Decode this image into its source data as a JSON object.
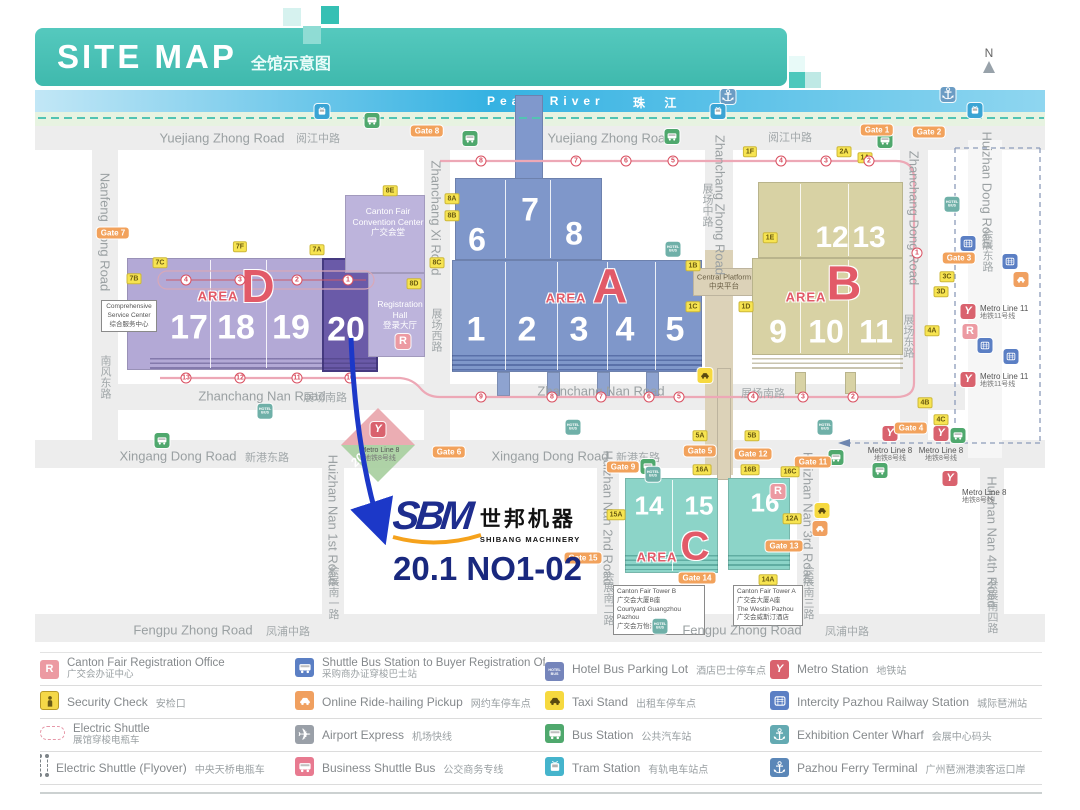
{
  "header": {
    "title": "SITE MAP",
    "subtitle": "全馆示意图"
  },
  "compass": {
    "label": "N"
  },
  "river": {
    "en": "Pearl River",
    "zh": "珠 江"
  },
  "callout": {
    "logo": "SBM",
    "logo_zh": "世邦机器",
    "logo_sub": "SHIBANG MACHINERY",
    "booth": "20.1 NO1-02"
  },
  "areas": {
    "a": {
      "word": "AREA",
      "letter": "A"
    },
    "b": {
      "word": "AREA",
      "letter": "B"
    },
    "c": {
      "word": "AREA",
      "letter": "C"
    },
    "d": {
      "word": "AREA",
      "letter": "D"
    }
  },
  "buildings": {
    "convention_center": {
      "l1": "Canton Fair",
      "l2": "Convention Center",
      "l3": "广交会堂"
    },
    "registration_hall": {
      "l1": "Registration",
      "l2": "Hall",
      "l3": "登录大厅"
    },
    "service_center": {
      "l1": "Comprehensive",
      "l2": "Service Center",
      "l3": "综合服务中心"
    },
    "central_platform": {
      "l1": "Central Platform",
      "l2": "中央平台"
    },
    "tower_b": {
      "l1": "Canton Fair Tower B",
      "l2": "广交会大厦B座",
      "l3": "Courtyard Guangzhou Pazhou",
      "l4": "广交会万怡酒店"
    },
    "tower_a": {
      "l1": "Canton Fair Tower A",
      "l2": "广交会大厦A座",
      "l3": "The Westin Pazhou",
      "l4": "广交会威斯汀酒店"
    }
  },
  "diamond": {
    "en": "Metro Line 8",
    "zh": "地铁8号线",
    "num": "20"
  },
  "halls": [
    {
      "t": "17",
      "x": 189,
      "y": 328,
      "s": 34
    },
    {
      "t": "18",
      "x": 236,
      "y": 328,
      "s": 34
    },
    {
      "t": "19",
      "x": 291,
      "y": 328,
      "s": 34
    },
    {
      "t": "20",
      "x": 346,
      "y": 330,
      "s": 34
    },
    {
      "t": "6",
      "x": 477,
      "y": 240,
      "s": 32
    },
    {
      "t": "7",
      "x": 530,
      "y": 210,
      "s": 32
    },
    {
      "t": "8",
      "x": 574,
      "y": 234,
      "s": 32
    },
    {
      "t": "1",
      "x": 476,
      "y": 330,
      "s": 34
    },
    {
      "t": "2",
      "x": 527,
      "y": 330,
      "s": 34
    },
    {
      "t": "3",
      "x": 579,
      "y": 330,
      "s": 34
    },
    {
      "t": "4",
      "x": 625,
      "y": 330,
      "s": 34
    },
    {
      "t": "5",
      "x": 675,
      "y": 330,
      "s": 34
    },
    {
      "t": "12",
      "x": 832,
      "y": 238,
      "s": 30
    },
    {
      "t": "13",
      "x": 869,
      "y": 238,
      "s": 30
    },
    {
      "t": "9",
      "x": 778,
      "y": 332,
      "s": 32
    },
    {
      "t": "10",
      "x": 826,
      "y": 332,
      "s": 32
    },
    {
      "t": "11",
      "x": 876,
      "y": 332,
      "s": 32
    },
    {
      "t": "14",
      "x": 649,
      "y": 506,
      "s": 26
    },
    {
      "t": "15",
      "x": 699,
      "y": 506,
      "s": 26
    },
    {
      "t": "16",
      "x": 765,
      "y": 503,
      "s": 26
    }
  ],
  "road_labels": [
    {
      "t": "Yuejiang Zhong Road",
      "x": 222,
      "y": 138
    },
    {
      "t": "阅江中路",
      "x": 318,
      "y": 138,
      "zh": 1
    },
    {
      "t": "Yuejiang Zhong Road",
      "x": 610,
      "y": 138
    },
    {
      "t": "阅江中路",
      "x": 790,
      "y": 137,
      "zh": 1
    },
    {
      "t": "Zhanchang Nan Road",
      "x": 262,
      "y": 396
    },
    {
      "t": "展场南路",
      "x": 325,
      "y": 397,
      "zh": 1
    },
    {
      "t": "Zhanchang Nan Road",
      "x": 601,
      "y": 391
    },
    {
      "t": "展场南路",
      "x": 763,
      "y": 393,
      "zh": 1
    },
    {
      "t": "Xingang Dong Road",
      "x": 178,
      "y": 456
    },
    {
      "t": "新港东路",
      "x": 267,
      "y": 457,
      "zh": 1
    },
    {
      "t": "Xingang Dong Road",
      "x": 550,
      "y": 456
    },
    {
      "t": "新港东路",
      "x": 638,
      "y": 457,
      "zh": 1
    },
    {
      "t": "Fengpu Zhong Road",
      "x": 193,
      "y": 630
    },
    {
      "t": "凤浦中路",
      "x": 288,
      "y": 631,
      "zh": 1
    },
    {
      "t": "Fengpu Zhong Road",
      "x": 742,
      "y": 630
    },
    {
      "t": "凤浦中路",
      "x": 847,
      "y": 631,
      "zh": 1
    },
    {
      "t": "Nanfeng Dong Road",
      "x": 105,
      "y": 232,
      "v": 1
    },
    {
      "t": "南风东路",
      "x": 105,
      "y": 377,
      "v": 1,
      "zh": 1
    },
    {
      "t": "Zhanchang Xi Road",
      "x": 436,
      "y": 218,
      "v": 1
    },
    {
      "t": "展场西路",
      "x": 436,
      "y": 330,
      "v": 1,
      "zh": 1
    },
    {
      "t": "Zhanchang Zhong Road",
      "x": 720,
      "y": 205,
      "v": 1
    },
    {
      "t": "展场中路",
      "x": 707,
      "y": 205,
      "v": 1,
      "zh": 1
    },
    {
      "t": "Zhanchang Dong Road",
      "x": 914,
      "y": 218,
      "v": 1
    },
    {
      "t": "展场东路",
      "x": 908,
      "y": 336,
      "v": 1,
      "zh": 1
    },
    {
      "t": "Huizhan Dong Road",
      "x": 987,
      "y": 190,
      "v": 1
    },
    {
      "t": "会展东路",
      "x": 987,
      "y": 250,
      "v": 1,
      "zh": 1
    },
    {
      "t": "Huizhan Nan 1st Road",
      "x": 333,
      "y": 520,
      "v": 1
    },
    {
      "t": "会展南一路",
      "x": 333,
      "y": 592,
      "v": 1,
      "zh": 1
    },
    {
      "t": "Huizhan Nan 2nd Road",
      "x": 608,
      "y": 518,
      "v": 1
    },
    {
      "t": "会展南二路",
      "x": 608,
      "y": 598,
      "v": 1,
      "zh": 1
    },
    {
      "t": "Huizhan Nan 3rd Road",
      "x": 808,
      "y": 518,
      "v": 1
    },
    {
      "t": "会展南三路",
      "x": 808,
      "y": 592,
      "v": 1,
      "zh": 1
    },
    {
      "t": "Huizhan Nan 4th Road",
      "x": 992,
      "y": 542,
      "v": 1
    },
    {
      "t": "会展南四路",
      "x": 992,
      "y": 606,
      "v": 1,
      "zh": 1
    }
  ],
  "gates": [
    {
      "t": "Gate 7",
      "x": 113,
      "y": 233
    },
    {
      "t": "Gate 8",
      "x": 427,
      "y": 131
    },
    {
      "t": "Gate 1",
      "x": 877,
      "y": 130
    },
    {
      "t": "Gate 2",
      "x": 929,
      "y": 132
    },
    {
      "t": "Gate 3",
      "x": 959,
      "y": 258
    },
    {
      "t": "Gate 4",
      "x": 911,
      "y": 428
    },
    {
      "t": "Gate 6",
      "x": 449,
      "y": 452
    },
    {
      "t": "Gate 9",
      "x": 623,
      "y": 467
    },
    {
      "t": "Gate 5",
      "x": 700,
      "y": 451
    },
    {
      "t": "Gate 12",
      "x": 753,
      "y": 454
    },
    {
      "t": "Gate 11",
      "x": 813,
      "y": 462
    },
    {
      "t": "Gate 13",
      "x": 784,
      "y": 546
    },
    {
      "t": "Gate 14",
      "x": 697,
      "y": 578
    },
    {
      "t": "Gate 15",
      "x": 583,
      "y": 558
    }
  ],
  "badges": [
    {
      "t": "7B",
      "x": 134,
      "y": 279
    },
    {
      "t": "7C",
      "x": 160,
      "y": 263
    },
    {
      "t": "7F",
      "x": 240,
      "y": 247
    },
    {
      "t": "7A",
      "x": 317,
      "y": 250
    },
    {
      "t": "8E",
      "x": 390,
      "y": 191
    },
    {
      "t": "8A",
      "x": 452,
      "y": 199
    },
    {
      "t": "8B",
      "x": 452,
      "y": 216
    },
    {
      "t": "8C",
      "x": 437,
      "y": 263
    },
    {
      "t": "8D",
      "x": 414,
      "y": 284
    },
    {
      "t": "1A",
      "x": 865,
      "y": 158
    },
    {
      "t": "1F",
      "x": 750,
      "y": 152
    },
    {
      "t": "2A",
      "x": 844,
      "y": 152
    },
    {
      "t": "1B",
      "x": 693,
      "y": 266
    },
    {
      "t": "1C",
      "x": 693,
      "y": 307
    },
    {
      "t": "1D",
      "x": 746,
      "y": 307
    },
    {
      "t": "1E",
      "x": 770,
      "y": 238
    },
    {
      "t": "3C",
      "x": 947,
      "y": 277
    },
    {
      "t": "3D",
      "x": 941,
      "y": 292
    },
    {
      "t": "4A",
      "x": 932,
      "y": 331
    },
    {
      "t": "4B",
      "x": 925,
      "y": 403
    },
    {
      "t": "4C",
      "x": 941,
      "y": 420
    },
    {
      "t": "5A",
      "x": 700,
      "y": 436
    },
    {
      "t": "5B",
      "x": 752,
      "y": 436
    },
    {
      "t": "16A",
      "x": 702,
      "y": 470
    },
    {
      "t": "16B",
      "x": 750,
      "y": 470
    },
    {
      "t": "16C",
      "x": 790,
      "y": 472
    },
    {
      "t": "12A",
      "x": 792,
      "y": 519
    },
    {
      "t": "14A",
      "x": 768,
      "y": 580
    },
    {
      "t": "15A",
      "x": 616,
      "y": 515
    }
  ],
  "metro_labels": [
    {
      "en": "Metro Line 11",
      "zh": "地铁11号线",
      "x": 980,
      "y": 304
    },
    {
      "en": "Metro Line 11",
      "zh": "地铁11号线",
      "x": 980,
      "y": 372
    },
    {
      "en": "Metro Line 8",
      "zh": "地铁8号线",
      "x": 890,
      "y": 446,
      "c": 1
    },
    {
      "en": "Metro Line 8",
      "zh": "地铁8号线",
      "x": 941,
      "y": 446,
      "c": 1
    },
    {
      "en": "Metro Line 8",
      "zh": "地铁8号线",
      "x": 962,
      "y": 488
    }
  ],
  "markers": [
    {
      "t": "anchor",
      "x": 728,
      "y": 97
    },
    {
      "t": "anchor",
      "x": 948,
      "y": 95
    },
    {
      "t": "tramM",
      "x": 322,
      "y": 113
    },
    {
      "t": "tramM",
      "x": 718,
      "y": 113
    },
    {
      "t": "tramM",
      "x": 975,
      "y": 112
    },
    {
      "t": "bus",
      "x": 372,
      "y": 122
    },
    {
      "t": "bus",
      "x": 470,
      "y": 140
    },
    {
      "t": "bus",
      "x": 672,
      "y": 138
    },
    {
      "t": "bus",
      "x": 885,
      "y": 142
    },
    {
      "t": "bus",
      "x": 162,
      "y": 442
    },
    {
      "t": "bus",
      "x": 648,
      "y": 468
    },
    {
      "t": "bus",
      "x": 836,
      "y": 459
    },
    {
      "t": "bus",
      "x": 958,
      "y": 437
    },
    {
      "t": "bus",
      "x": 880,
      "y": 472
    },
    {
      "t": "hotelM",
      "x": 952,
      "y": 200
    },
    {
      "t": "hotelM",
      "x": 673,
      "y": 245
    },
    {
      "t": "hotelM",
      "x": 265,
      "y": 407
    },
    {
      "t": "hotelM",
      "x": 573,
      "y": 423
    },
    {
      "t": "hotelM",
      "x": 825,
      "y": 423
    },
    {
      "t": "hotelM",
      "x": 653,
      "y": 470
    },
    {
      "t": "hotelM",
      "x": 660,
      "y": 622
    },
    {
      "t": "taxi",
      "x": 705,
      "y": 377
    },
    {
      "t": "taxi",
      "x": 822,
      "y": 512
    },
    {
      "t": "ride",
      "x": 820,
      "y": 530
    },
    {
      "t": "ride",
      "x": 1021,
      "y": 281
    },
    {
      "t": "rail",
      "x": 968,
      "y": 245
    },
    {
      "t": "rail",
      "x": 1010,
      "y": 263
    },
    {
      "t": "rail",
      "x": 985,
      "y": 347
    },
    {
      "t": "rail",
      "x": 1011,
      "y": 358
    },
    {
      "t": "metro",
      "x": 968,
      "y": 310
    },
    {
      "t": "metro",
      "x": 968,
      "y": 378
    },
    {
      "t": "metro",
      "x": 890,
      "y": 432
    },
    {
      "t": "metro",
      "x": 941,
      "y": 432
    },
    {
      "t": "metro",
      "x": 950,
      "y": 477
    },
    {
      "t": "metro",
      "x": 378,
      "y": 428
    },
    {
      "t": "r",
      "x": 403,
      "y": 340
    },
    {
      "t": "r",
      "x": 970,
      "y": 330
    },
    {
      "t": "r",
      "x": 778,
      "y": 490
    }
  ],
  "route_stops": [
    {
      "n": "8",
      "x": 481,
      "y": 161
    },
    {
      "n": "7",
      "x": 576,
      "y": 161
    },
    {
      "n": "6",
      "x": 626,
      "y": 161
    },
    {
      "n": "5",
      "x": 673,
      "y": 161
    },
    {
      "n": "4",
      "x": 781,
      "y": 161
    },
    {
      "n": "3",
      "x": 826,
      "y": 161
    },
    {
      "n": "2",
      "x": 869,
      "y": 161
    },
    {
      "n": "1",
      "x": 917,
      "y": 253
    },
    {
      "n": "4",
      "x": 186,
      "y": 280
    },
    {
      "n": "3",
      "x": 240,
      "y": 280
    },
    {
      "n": "2",
      "x": 297,
      "y": 280
    },
    {
      "n": "1",
      "x": 348,
      "y": 280
    },
    {
      "n": "13",
      "x": 186,
      "y": 378
    },
    {
      "n": "12",
      "x": 240,
      "y": 378
    },
    {
      "n": "11",
      "x": 297,
      "y": 378
    },
    {
      "n": "10",
      "x": 350,
      "y": 378
    },
    {
      "n": "9",
      "x": 481,
      "y": 397
    },
    {
      "n": "8",
      "x": 552,
      "y": 397
    },
    {
      "n": "7",
      "x": 601,
      "y": 397
    },
    {
      "n": "6",
      "x": 649,
      "y": 397
    },
    {
      "n": "5",
      "x": 679,
      "y": 397
    },
    {
      "n": "4",
      "x": 753,
      "y": 397
    },
    {
      "n": "3",
      "x": 803,
      "y": 397
    },
    {
      "n": "2",
      "x": 853,
      "y": 397
    }
  ],
  "legend": {
    "items": [
      {
        "icon": "r",
        "en": "Canton Fair Registration Office",
        "zh": "广交会办证中心",
        "s": 1
      },
      {
        "icon": "shuttlebus",
        "en": "Shuttle Bus Station to Buyer Registration Office",
        "zh": "采购商办证穿梭巴士站",
        "s": 1
      },
      {
        "icon": "hotel",
        "en": "Hotel Bus Parking Lot",
        "zh": "酒店巴士停车点"
      },
      {
        "icon": "metro",
        "en": "Metro Station",
        "zh": "地铁站"
      },
      {
        "icon": "sec",
        "en": "Security Check",
        "zh": "安检口"
      },
      {
        "icon": "ride",
        "en": "Online Ride-hailing Pickup",
        "zh": "网约车停车点"
      },
      {
        "icon": "taxi",
        "en": "Taxi Stand",
        "zh": "出租车停车点"
      },
      {
        "icon": "rail",
        "en": "Intercity Pazhou Railway Station",
        "zh": "城际琶洲站"
      },
      {
        "icon": "loop",
        "en": "Electric Shuttle",
        "zh": "展馆穿梭电瓶车",
        "s": 1
      },
      {
        "icon": "air",
        "en": "Airport Express",
        "zh": "机场快线"
      },
      {
        "icon": "bus",
        "en": "Bus Station",
        "zh": "公共汽车站"
      },
      {
        "icon": "anchorT",
        "en": "Exhibition Center Wharf",
        "zh": "会展中心码头"
      },
      {
        "icon": "fly",
        "en": "Electric Shuttle (Flyover)",
        "zh": "中央天桥电瓶车"
      },
      {
        "icon": "busline",
        "en": "Business Shuttle Bus",
        "zh": "公交商务专线"
      },
      {
        "icon": "tram",
        "en": "Tram Station",
        "zh": "有轨电车站点"
      },
      {
        "icon": "anchorB",
        "en": "Pazhou Ferry Terminal",
        "zh": "广州琶洲港澳客运口岸"
      }
    ]
  }
}
